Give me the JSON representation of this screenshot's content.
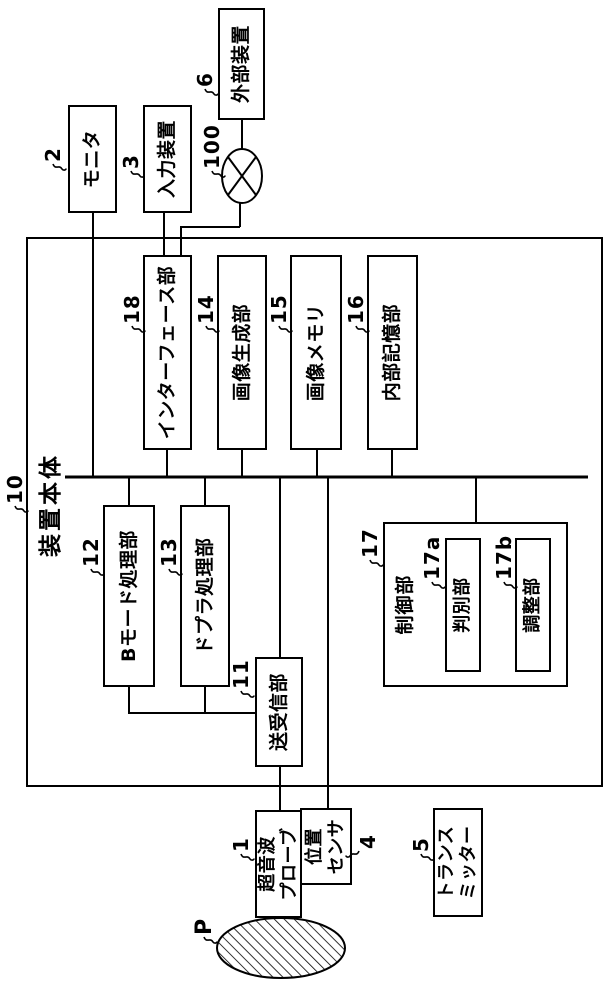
{
  "figure": {
    "kind": "ultrasound-apparatus-block-diagram",
    "orientation": "rotated-90-ccw",
    "background": "#ffffff",
    "line_color": "#000000",
    "blocks": {
      "main_body": {
        "ref": "10",
        "label": "装置本体"
      },
      "monitor": {
        "ref": "2",
        "label": "モニタ"
      },
      "input_device": {
        "ref": "3",
        "label": "入力装置"
      },
      "external_device": {
        "ref": "6",
        "label": "外部装置"
      },
      "network": {
        "ref": "100",
        "icon": "public-line-circle-x"
      },
      "interface": {
        "ref": "18",
        "label": "インターフェース部"
      },
      "image_generator": {
        "ref": "14",
        "label": "画像生成部"
      },
      "image_memory": {
        "ref": "15",
        "label": "画像メモリ"
      },
      "internal_storage": {
        "ref": "16",
        "label": "内部記憶部"
      },
      "b_mode": {
        "ref": "12",
        "label": "Bモード処理部"
      },
      "doppler": {
        "ref": "13",
        "label": "ドプラ処理部"
      },
      "tx_rx": {
        "ref": "11",
        "label": "送受信部"
      },
      "control": {
        "ref": "17",
        "label": "制御部"
      },
      "discriminator": {
        "ref": "17a",
        "label": "判別部"
      },
      "adjuster": {
        "ref": "17b",
        "label": "調整部"
      },
      "ultrasound_probe": {
        "ref": "1",
        "label": "超音波\nプローブ"
      },
      "position_sensor": {
        "ref": "4",
        "label": "位置\nセンサ"
      },
      "transmitter": {
        "ref": "5",
        "label": "トランス\nミッター"
      },
      "subject": {
        "ref": "P",
        "icon": "hatched-body-ellipse"
      }
    }
  }
}
